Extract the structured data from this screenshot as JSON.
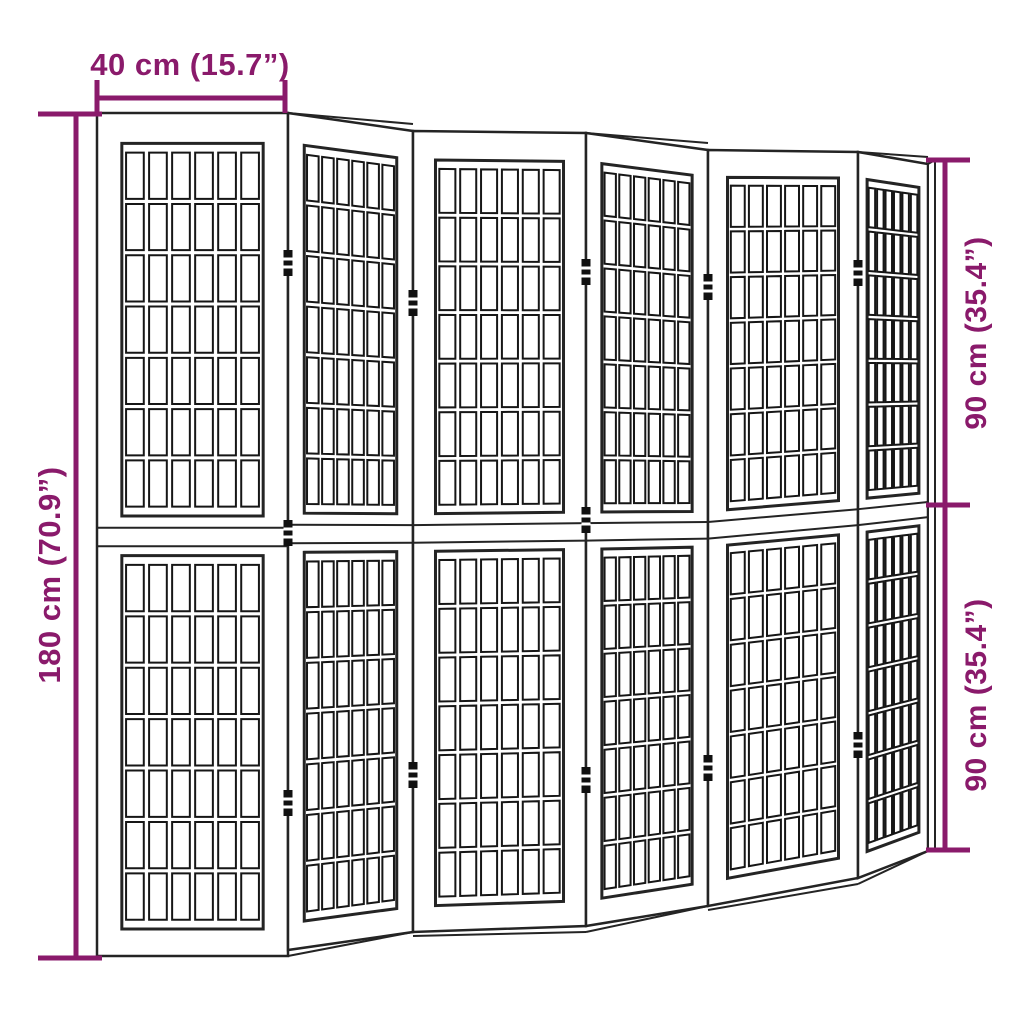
{
  "diagram": {
    "width_label": "40 cm (15.7”)",
    "height_label": "180 cm (70.9”)",
    "upper_half_label": "90 cm (35.4”)",
    "lower_half_label": "90 cm (35.4”)"
  },
  "colors": {
    "dimension": "#8a1a6b",
    "outline": "#242424",
    "lattice": "#161616",
    "background": "#ffffff",
    "panel_fill": "#ffffff"
  },
  "figure": {
    "type": "folding-room-divider",
    "panel_count": 6,
    "grid": {
      "cols": 6,
      "rows": 7
    },
    "rail_v": [
      0.492,
      0.514
    ],
    "halves_v": [
      [
        0.036,
        0.478
      ],
      [
        0.525,
        0.968
      ]
    ],
    "frame_inset_u": 0.13,
    "panels": [
      {
        "x1": 97,
        "x2": 288,
        "yTL": 113,
        "yTR": 113,
        "yBL": 956,
        "yBR": 956,
        "angled": false,
        "floor": false
      },
      {
        "x1": 288,
        "x2": 413,
        "yTL": 113,
        "yTR": 131,
        "yBL": 950,
        "yBR": 932,
        "angled": true,
        "floor": false
      },
      {
        "x1": 413,
        "x2": 586,
        "yTL": 131,
        "yTR": 133,
        "yBL": 932,
        "yBR": 926,
        "angled": false,
        "floor": true
      },
      {
        "x1": 586,
        "x2": 708,
        "yTL": 133,
        "yTR": 150,
        "yBL": 926,
        "yBR": 906,
        "angled": true,
        "floor": false
      },
      {
        "x1": 708,
        "x2": 858,
        "yTL": 150,
        "yTR": 152,
        "yBL": 906,
        "yBR": 878,
        "angled": false,
        "floor": true
      },
      {
        "x1": 858,
        "x2": 928,
        "yTL": 152,
        "yTR": 164,
        "yBL": 878,
        "yBR": 851,
        "angled": true,
        "floor": false
      }
    ],
    "hinges": [
      {
        "x": 288,
        "y": 263
      },
      {
        "x": 288,
        "y": 533
      },
      {
        "x": 288,
        "y": 803
      },
      {
        "x": 413,
        "y": 303
      },
      {
        "x": 413,
        "y": 775
      },
      {
        "x": 586,
        "y": 272
      },
      {
        "x": 586,
        "y": 520
      },
      {
        "x": 586,
        "y": 780
      },
      {
        "x": 708,
        "y": 287
      },
      {
        "x": 708,
        "y": 768
      },
      {
        "x": 858,
        "y": 273
      },
      {
        "x": 858,
        "y": 745
      }
    ],
    "dimension_lines": {
      "top": {
        "y": 98,
        "x1": 97,
        "x2": 285,
        "tick_y1": 80,
        "tick_y2": 113
      },
      "left": {
        "x": 76,
        "y1": 114,
        "y2": 958,
        "tick_x1": 38,
        "tick_x2": 102
      },
      "right": {
        "x": 945,
        "segments": [
          [
            160,
            505
          ],
          [
            505,
            850
          ]
        ],
        "tick_x1": 926,
        "tick_x2": 970
      }
    }
  }
}
